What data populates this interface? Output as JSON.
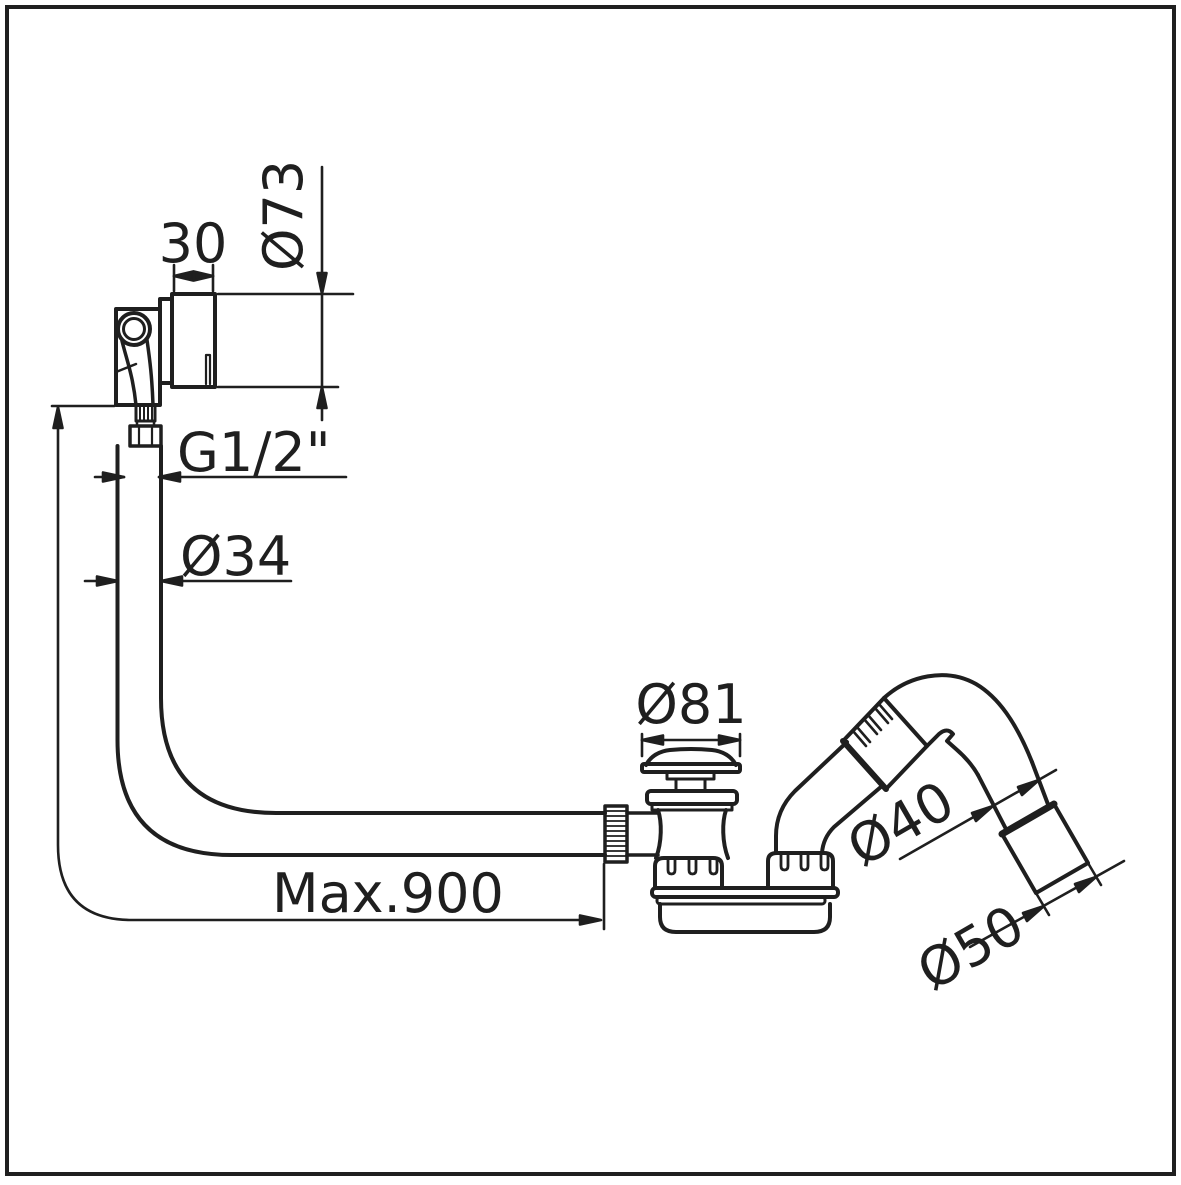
{
  "drawing": {
    "type": "technical-dimension-drawing",
    "subject": "bath waste, overflow filler and flexible hose assembly",
    "colors": {
      "line": "#1f1f1f",
      "background": "#ffffff"
    },
    "dimensions": [
      {
        "id": "overflow-body-depth",
        "label": "30"
      },
      {
        "id": "overflow-face-diameter",
        "label": "Ø73"
      },
      {
        "id": "overflow-thread",
        "label": "G1/2\""
      },
      {
        "id": "overflow-hose-diameter",
        "label": "Ø34"
      },
      {
        "id": "waste-plug-diameter",
        "label": "Ø81"
      },
      {
        "id": "outlet-pipe-diameter",
        "label": "Ø40"
      },
      {
        "id": "outlet-socket-diameter",
        "label": "Ø50"
      },
      {
        "id": "hose-max-length",
        "label": "Max.900"
      }
    ]
  }
}
